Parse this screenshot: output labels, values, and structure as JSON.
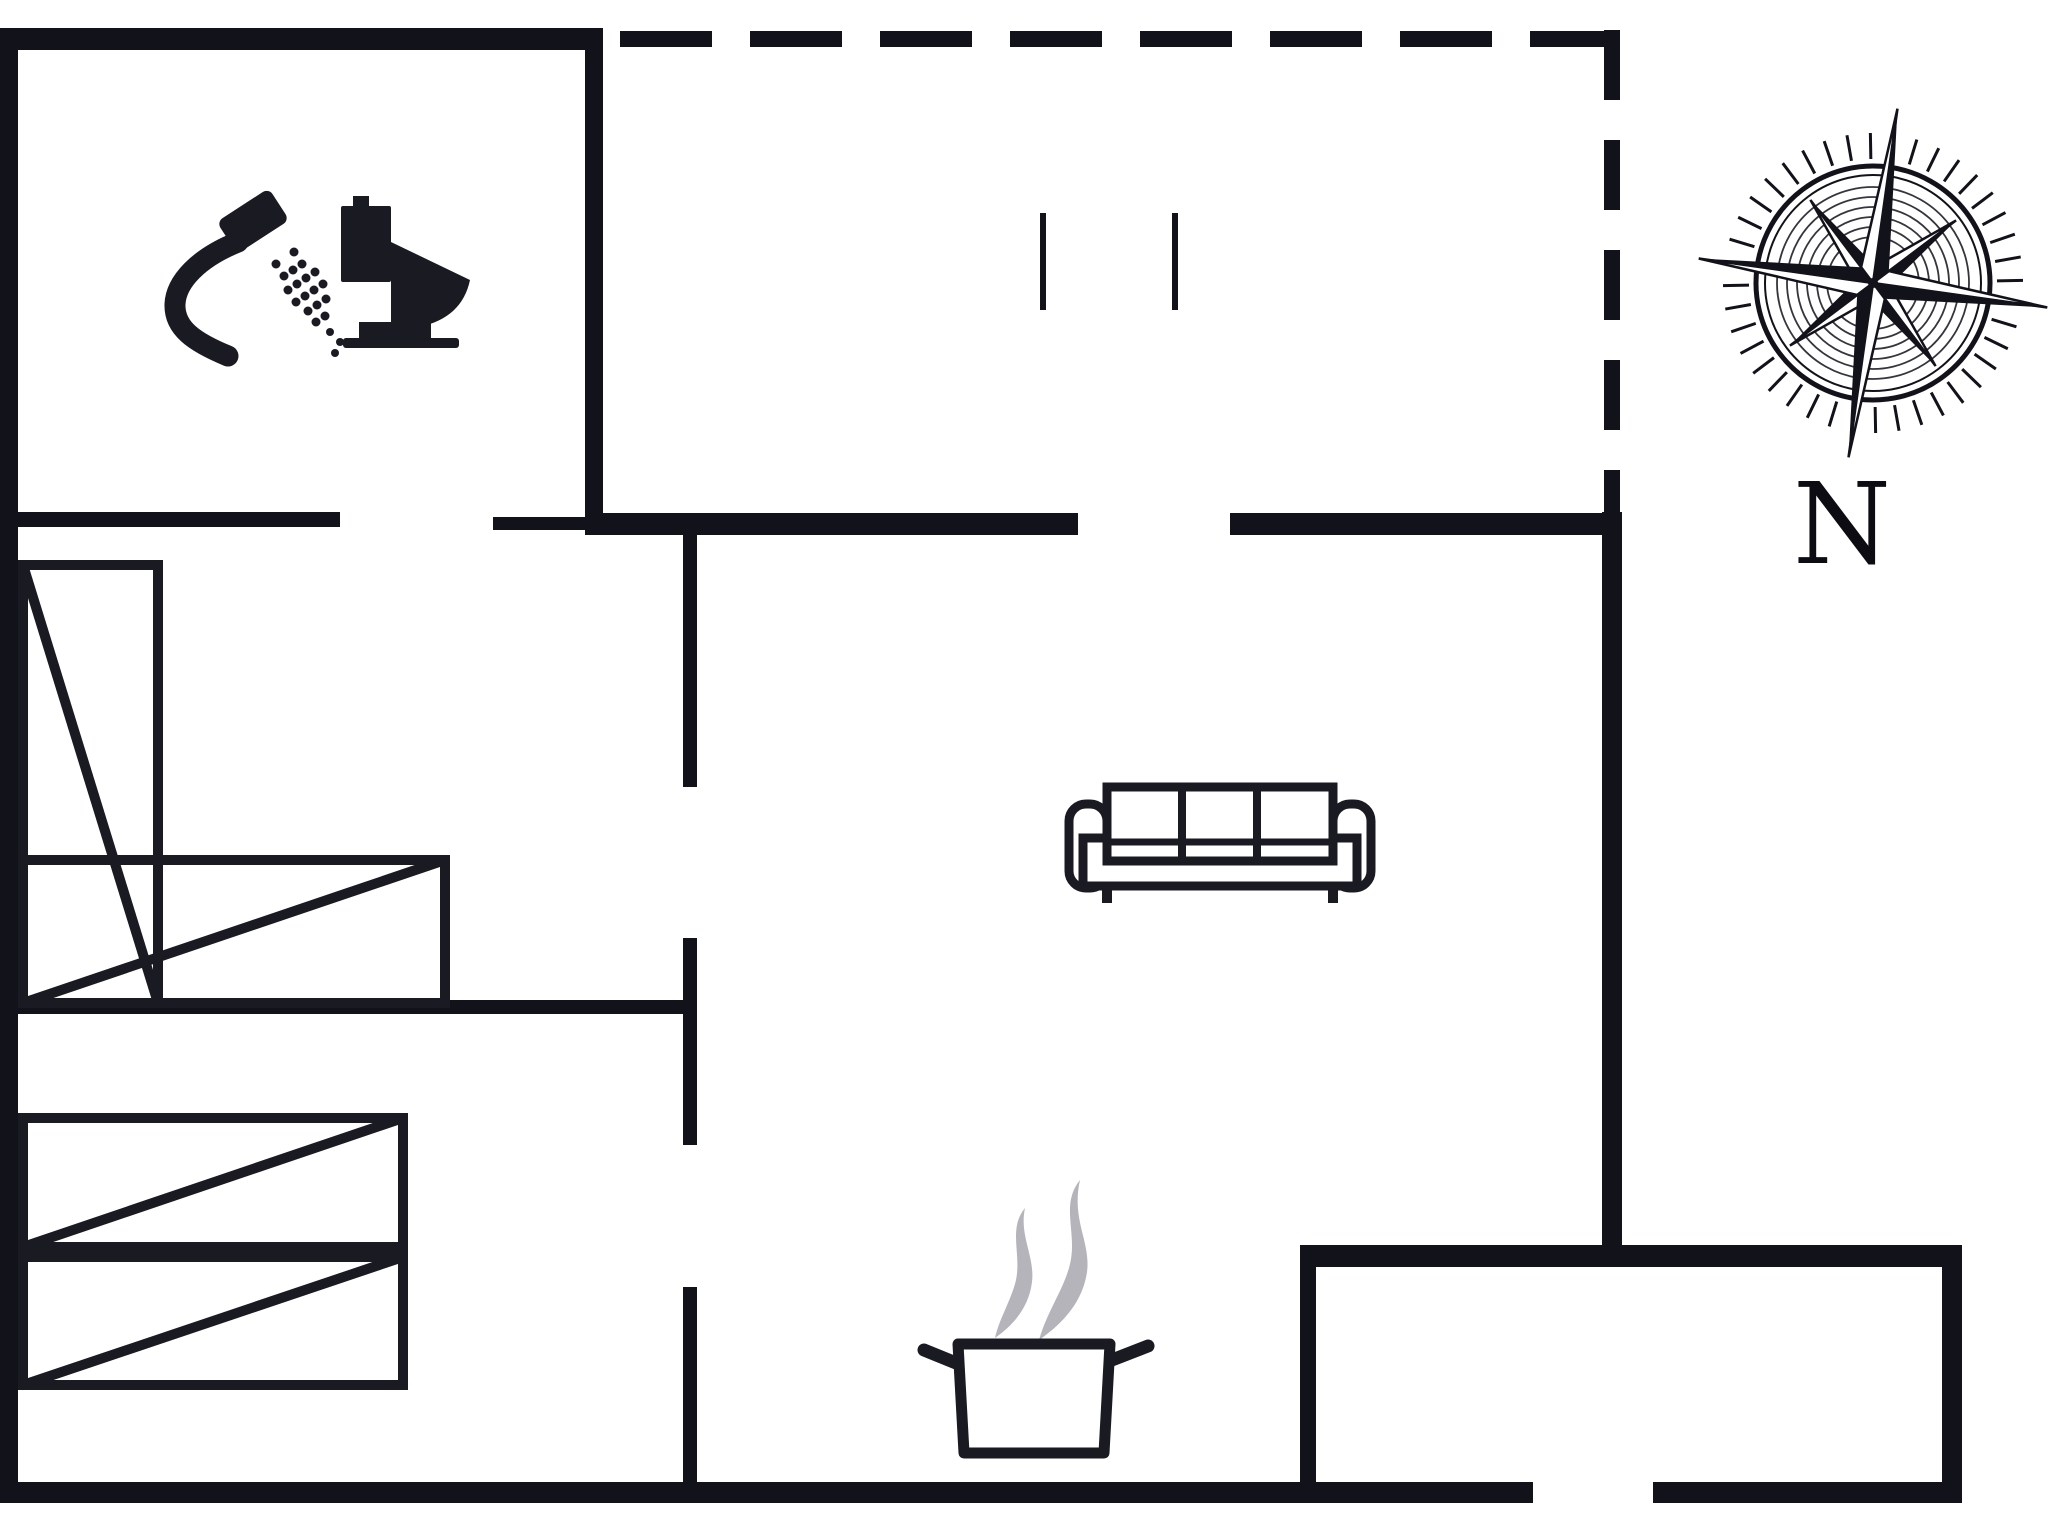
{
  "canvas": {
    "width": 2048,
    "height": 1536,
    "viewbox": "0 0 2048 1536",
    "background": "#ffffff"
  },
  "colors": {
    "wall": "#12121a",
    "furniture": "#1a1a23",
    "steam": "#b4b4ba",
    "label": "#0c0c12"
  },
  "compass": {
    "label": "N",
    "transform": "translate(1873,283) rotate(8)",
    "label_transform": "translate(1842,563)",
    "tick_count": 40,
    "tick_inner": 124,
    "tick_outer": 150,
    "rings": [
      {
        "r": 117,
        "w": 5
      },
      {
        "r": 108,
        "w": 2
      }
    ],
    "inner_circles": [
      96,
      86,
      76,
      66,
      56,
      46
    ],
    "main_points": {
      "length": 176,
      "half_width": 14,
      "angles": [
        0,
        90,
        180,
        270
      ]
    },
    "minor_points": {
      "length": 104,
      "half_width": 12,
      "angles": [
        45,
        135,
        225,
        315
      ]
    }
  },
  "walls": {
    "solid": [
      {
        "name": "wall-left",
        "x": 0,
        "y": 28,
        "w": 18,
        "h": 1475
      },
      {
        "name": "wall-top",
        "x": 0,
        "y": 28,
        "w": 603,
        "h": 22
      },
      {
        "name": "wall-bathroom-right",
        "x": 585,
        "y": 28,
        "w": 18,
        "h": 505
      },
      {
        "name": "wall-bathroom-bottom-left",
        "x": 0,
        "y": 512,
        "w": 340,
        "h": 15
      },
      {
        "name": "wall-bathroom-bottom-right",
        "x": 493,
        "y": 517,
        "w": 92,
        "h": 13
      },
      {
        "name": "wall-hall-bottom-left",
        "x": 585,
        "y": 513,
        "w": 493,
        "h": 22
      },
      {
        "name": "wall-hall-bottom-right",
        "x": 1230,
        "y": 513,
        "w": 392,
        "h": 22
      },
      {
        "name": "wall-right",
        "x": 1602,
        "y": 512,
        "w": 20,
        "h": 755
      },
      {
        "name": "wall-bedrooms-divider",
        "x": 0,
        "y": 1000,
        "w": 690,
        "h": 14
      },
      {
        "name": "wall-corridor-top",
        "x": 683,
        "y": 533,
        "w": 14,
        "h": 254
      },
      {
        "name": "wall-corridor-mid",
        "x": 683,
        "y": 938,
        "w": 14,
        "h": 207
      },
      {
        "name": "wall-corridor-bottom",
        "x": 683,
        "y": 1287,
        "w": 14,
        "h": 200
      },
      {
        "name": "wall-bottom-left",
        "x": 0,
        "y": 1482,
        "w": 1533,
        "h": 21
      },
      {
        "name": "wall-bottom-right",
        "x": 1653,
        "y": 1482,
        "w": 309,
        "h": 21
      },
      {
        "name": "wall-annex-top",
        "x": 1300,
        "y": 1245,
        "w": 662,
        "h": 22
      },
      {
        "name": "wall-kitchen-right",
        "x": 1300,
        "y": 1245,
        "w": 16,
        "h": 258
      },
      {
        "name": "wall-annex-right",
        "x": 1942,
        "y": 1267,
        "w": 20,
        "h": 236
      },
      {
        "name": "window-marker-1",
        "x": 1040,
        "y": 213,
        "w": 6,
        "h": 97
      },
      {
        "name": "window-marker-2",
        "x": 1172,
        "y": 213,
        "w": 6,
        "h": 97
      }
    ],
    "dashed": [
      {
        "name": "wall-terrace-top",
        "x1": 620,
        "y1": 39,
        "x2": 1612,
        "y2": 39,
        "w": 16,
        "dash": "92 38"
      },
      {
        "name": "wall-terrace-right",
        "x1": 1612,
        "y1": 30,
        "x2": 1612,
        "y2": 512,
        "w": 16,
        "dash": "70 40"
      }
    ]
  },
  "furniture": {
    "beds": {
      "stroke_width": 10,
      "items": [
        {
          "name": "bed-1",
          "x": 23,
          "y": 565,
          "w": 135,
          "h": 438,
          "diag": "tl-br"
        },
        {
          "name": "bed-2",
          "x": 23,
          "y": 860,
          "w": 422,
          "h": 143,
          "diag": "bl-tr"
        },
        {
          "name": "bed-3",
          "x": 23,
          "y": 1118,
          "w": 380,
          "h": 129,
          "diag": "bl-tr"
        },
        {
          "name": "bed-4",
          "x": 23,
          "y": 1257,
          "w": 380,
          "h": 128,
          "diag": "bl-tr"
        }
      ]
    },
    "sofa": {
      "transform": "translate(1068,785)"
    },
    "pot": {
      "transform": "translate(918,1338)"
    },
    "steam": {
      "transform": "translate(985,1172)"
    },
    "shower": {
      "transform": "translate(160,190)"
    },
    "toilet": {
      "transform": "translate(341,196)"
    }
  }
}
